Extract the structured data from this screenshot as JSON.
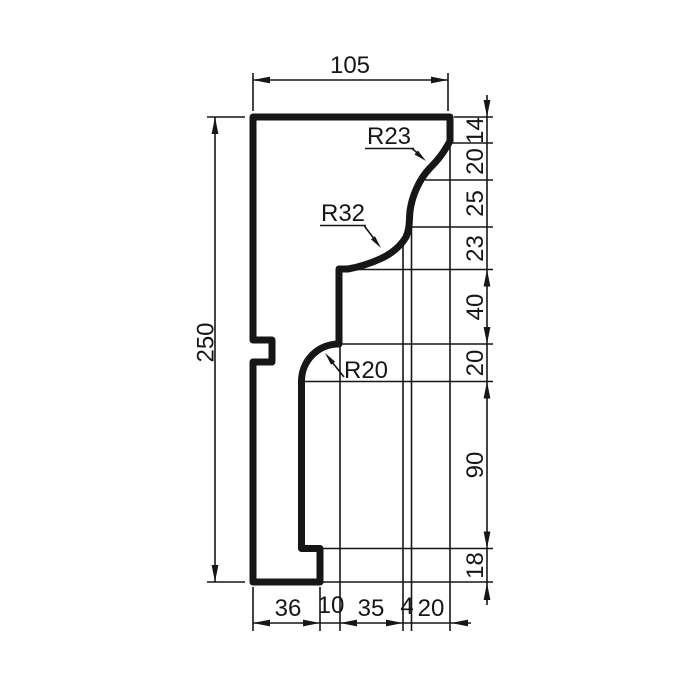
{
  "drawing": {
    "background": "#ffffff",
    "line_color": "#161616",
    "dim_top": {
      "label": "105"
    },
    "dim_left": {
      "label": "250"
    },
    "right_chain": {
      "labels": [
        "14",
        "20",
        "25",
        "23",
        "40",
        "20",
        "90",
        "18"
      ]
    },
    "bottom_chain": {
      "labels": [
        "36",
        "10",
        "35",
        "4",
        "20"
      ]
    },
    "radii": {
      "r23": "R23",
      "r32": "R32",
      "r20": "R20"
    }
  }
}
